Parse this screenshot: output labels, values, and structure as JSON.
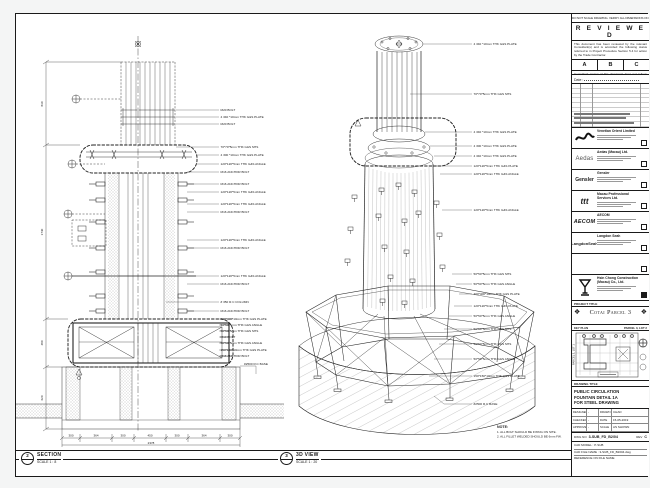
{
  "views": {
    "section": {
      "bubble_no": "2",
      "title": "SECTION",
      "scale": "SCALE 1 : 8",
      "callouts": [
        "M20 BOLT",
        "4 340 *10mm THK G&S PLATE",
        "M20 BOLT",
        "70*70*5mm THK G&S SHS",
        "4 300 *10mm THK G&S PLATE",
        "120*120*5mm THK G&S ANGLE",
        "M16 ANCHOR BOLT",
        "M16 ANCHOR BOLT",
        "120*120*5mm THK G&S ANGLE",
        "120*120*5mm THK G&S ANGLE",
        "M16 ANCHOR BOLT",
        "120*120*5mm THK G&S ANGLE",
        "M16 ANCHOR BOLT",
        "120*120*5mm THK G&S ANGLE",
        "M16 ANCHOR BOLT",
        "# 350 R.C COLUMN",
        "M16 ANCHOR BOLT",
        "400*400*10mm THK G&S PLATE",
        "50*50*5mm THK G&S ANGLE",
        "50*50*5mm THK G&S SHS",
        "M10 BOLT",
        "50*50*5mm THK G&S ANGLE",
        "150*150*10mm THK G&S PLATE",
        "M16 ANCHOR BOLT",
        "#2500 R.C BASE"
      ],
      "dims_bottom": [
        "300",
        "364",
        "300",
        "450",
        "300",
        "364",
        "300"
      ],
      "dim_total": "2378",
      "dims_left": [
        "830",
        "1740",
        "480",
        "620"
      ]
    },
    "iso": {
      "bubble_no": "3",
      "title": "3D VIEW",
      "scale": "SCALE 1 : 20",
      "callouts": [
        "4 340 *10mm THK G&S PLATE",
        "70*70*5mm THK G&S SHS",
        "4 340 *10mm THK G&S PLATE",
        "4 300 *10mm THK G&S PLATE",
        "4 340 *10mm THK G&S PLATE",
        "120*120*5mm THK G&S PLATE",
        "120*120*5mm THK G&S ANGLE",
        "120*120*5mm THK G&S ANGLE",
        "50*50*5mm THK G&S SHS",
        "50*50*5mm THK G&S ANGLE",
        "400*400*10mm THK G&S PLATE",
        "120*120*5mm THK G&S PLATE",
        "50*50*5mm THK G&S ANGLE",
        "50*50*5mm THK G&S SHS",
        "50*50*5mm THK G&S SHS",
        "50*50*5mm THK G&S ANGLE",
        "150*150*10mm THK G&S PLATE",
        "#2500 R.C BASE"
      ],
      "note_title": "NOTE:",
      "note_lines": [
        "1. ALL BOLT SHOULD BE FIXING ON SITE.",
        "2. ALL FILLET WELDED SHOULD BE 6mm FW."
      ]
    }
  },
  "titleblock": {
    "top_note": "DO NOT SCALE DRAWING. VERIFY ALL DIMENSIONS ON SITE.",
    "reviewed": {
      "title": "R E V I E W E D",
      "para1": "This document has been reviewed by the relevant Consultant(s) and is accorded the following status referred to in Project Procedure Section 5.4 for action by the Trade Contractor.",
      "boxes": [
        "A",
        "B",
        "C"
      ],
      "para2": "Consultant review of this document does not relieve the Trade Contractor of the responsibilities under the Trade Contract.",
      "date_label": "Date :"
    },
    "consultants": [
      {
        "name": "Venetian Orient Limited"
      },
      {
        "logo_text": "Aedas",
        "name": "Aedas (Macau) Ltd."
      },
      {
        "logo_text": "Gensler",
        "name": "Gensler"
      },
      {
        "logo_text": "ttt",
        "name": "Macau Professional Services Ltd."
      },
      {
        "logo_text": "AECOM",
        "name": "AECOM"
      },
      {
        "logo_text": "LangdonSeah",
        "name": "Langdon Seah"
      }
    ],
    "contractor": {
      "name": "Hsin Chong Construction (Macau) Co., Ltd."
    },
    "project": {
      "label": "PROJECT TITLE",
      "title": "Cotai Parcel 3",
      "emblem": "❖"
    },
    "keyplan": {
      "label": "KEY PLAN",
      "lot_right": "PARCEL 3, LOT 2",
      "lot_left": "PARCEL 3, LOT 1"
    },
    "drawing": {
      "label": "DRAWING TITLE",
      "line1": "PUBLIC CIRCULATION",
      "line2": "FOUNTAIN DETAIL 1A",
      "line3": "FOR STEEL DRAWING"
    },
    "fields": {
      "designed_label": "DESIGNED",
      "designed": "-",
      "drawn_label": "DRAWN",
      "drawn": "CHAD",
      "checked_label": "CHECKED",
      "checked": "-",
      "date_label": "DATE",
      "date": "15-05-2019",
      "approved_label": "APPROVED",
      "approved": "-",
      "scale_label": "SCALE",
      "scale": "AS SHOWN"
    },
    "dwg": {
      "label": "DWG NO",
      "no": "3-SUB_FD_B2/04",
      "rev_label": "REV",
      "rev": "C"
    },
    "cad": {
      "line1": "CAD MODEL : P-SUB",
      "line2": "CAD FILE NAME : 3-SUB_FD_B2004.dwg",
      "line3": "REFERENCE ON FILE NAME"
    }
  }
}
